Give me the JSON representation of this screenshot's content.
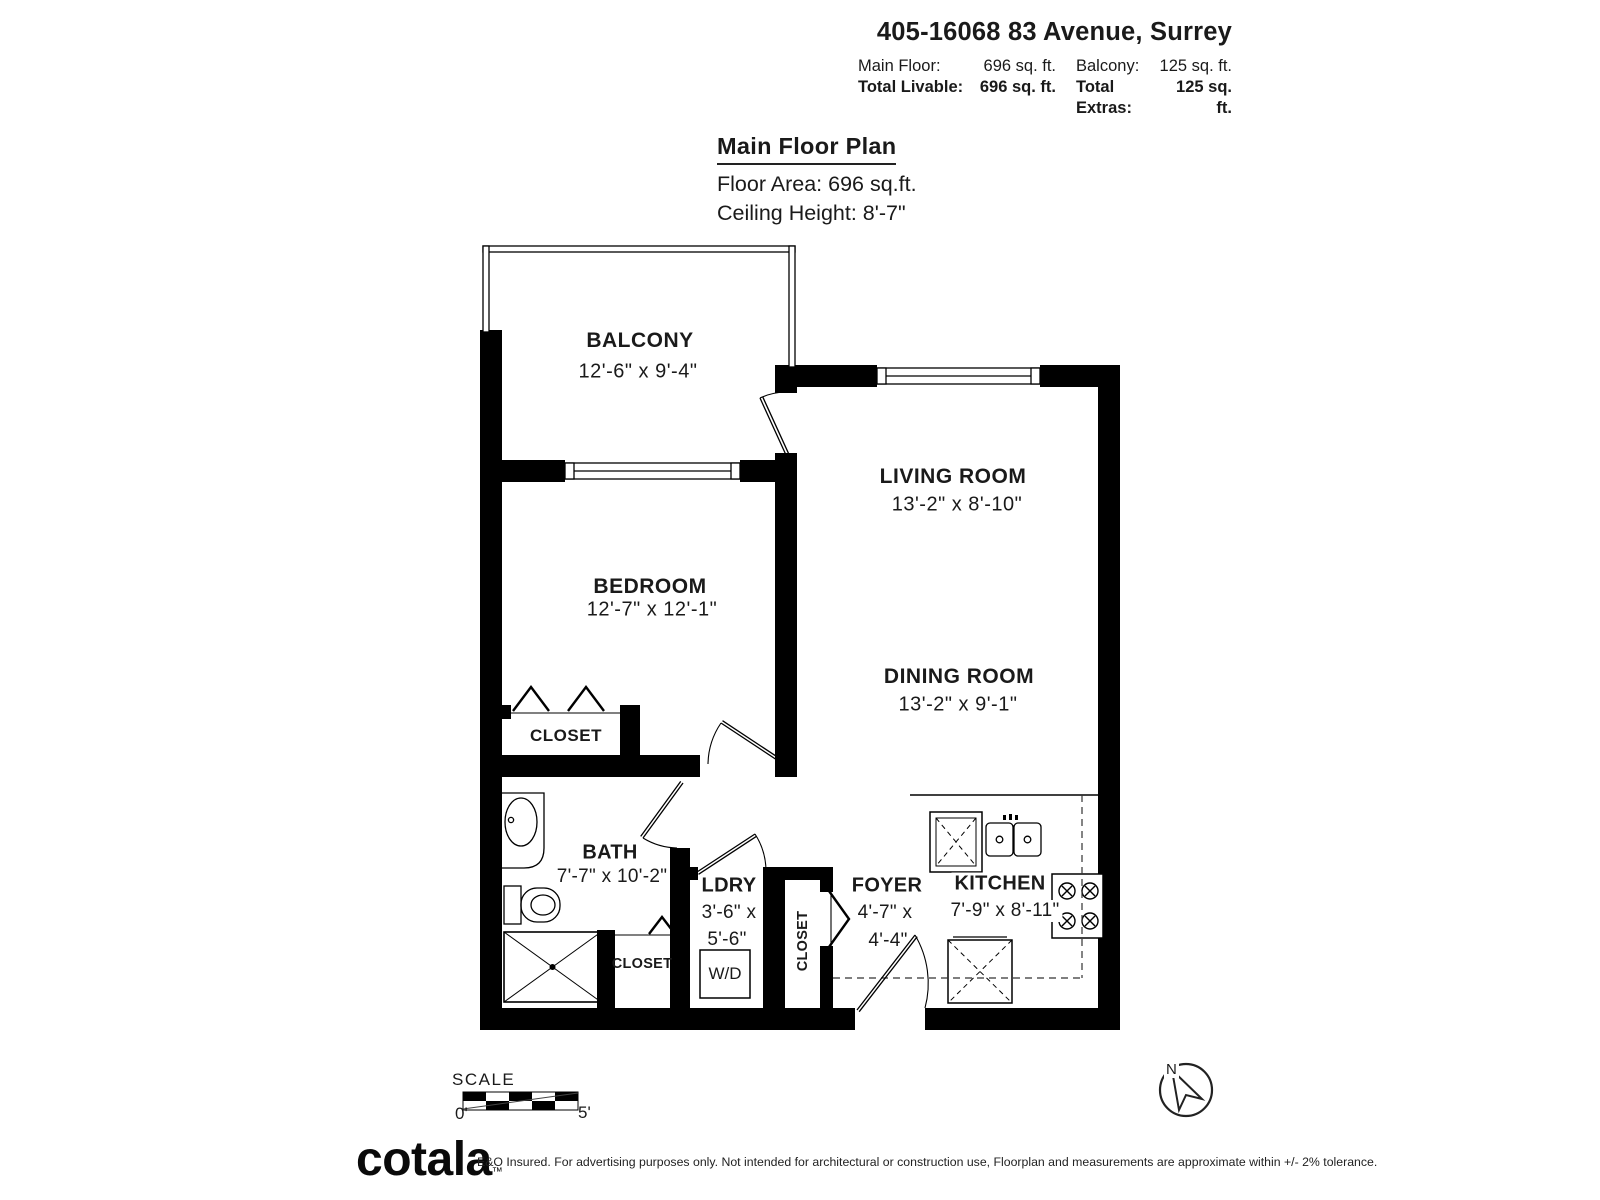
{
  "header": {
    "title": "405-16068 83 Avenue, Surrey",
    "row1": {
      "label1": "Main Floor:",
      "value1": "696 sq. ft.",
      "label2": "Balcony:",
      "value2": "125 sq. ft."
    },
    "row2": {
      "label1": "Total Livable:",
      "value1": "696 sq. ft.",
      "label2": "Total Extras:",
      "value2": "125 sq. ft."
    }
  },
  "plan_title": {
    "heading": "Main Floor Plan",
    "floor_area": "Floor Area: 696 sq.ft.",
    "ceiling_height": "Ceiling Height: 8'-7\""
  },
  "rooms": {
    "balcony": {
      "name": "BALCONY",
      "dims": "12'-6\" x 9'-4\""
    },
    "living_room": {
      "name": "LIVING ROOM",
      "dims": "13'-2\" x 8'-10\""
    },
    "bedroom": {
      "name": "BEDROOM",
      "dims": "12'-7\" x 12'-1\""
    },
    "dining_room": {
      "name": "DINING ROOM",
      "dims": "13'-2\" x 9'-1\""
    },
    "bath": {
      "name": "BATH",
      "dims": "7'-7\" x 10'-2\""
    },
    "laundry": {
      "name": "LDRY",
      "dims1": "3'-6\" x",
      "dims2": "5'-6\"",
      "appliance": "W/D"
    },
    "foyer": {
      "name": "FOYER",
      "dims1": "4'-7\" x",
      "dims2": "4'-4\""
    },
    "kitchen": {
      "name": "KITCHEN",
      "dims": "7'-9\" x 8'-11\""
    },
    "closet_bedroom": "CLOSET",
    "closet_bath": "CLOSET",
    "closet_foyer": "CLOSET"
  },
  "scale_bar": {
    "label": "SCALE",
    "min": "0'",
    "max": "5'"
  },
  "compass": {
    "north": "N"
  },
  "footer": {
    "brand": "cotala",
    "tm": "™",
    "disclaimer": "E&O Insured. For advertising purposes only. Not intended for architectural or construction use, Floorplan and measurements are approximate within +/- 2% tolerance."
  },
  "colors": {
    "ink": "#1a1a1a",
    "wall": "#000000",
    "background": "#ffffff"
  }
}
